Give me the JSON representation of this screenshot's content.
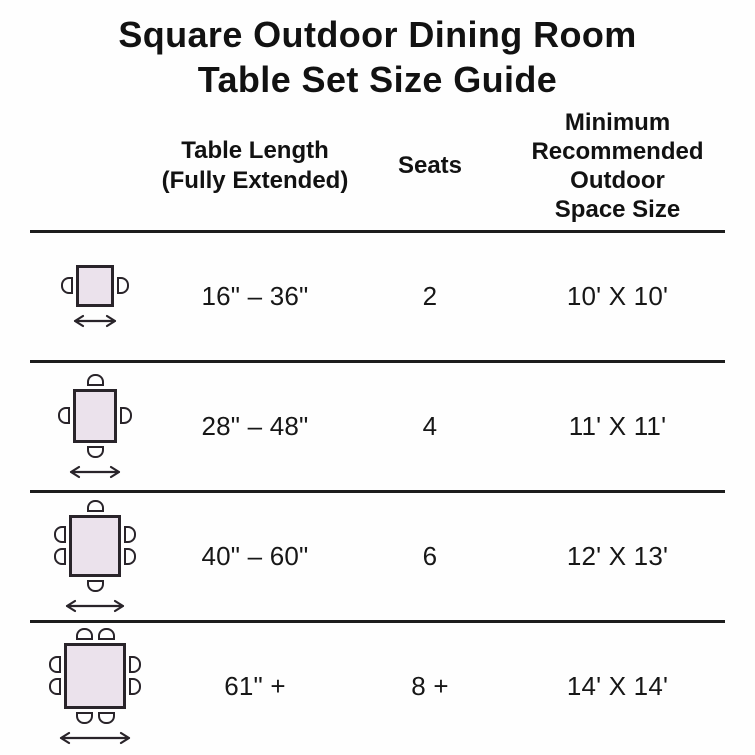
{
  "title": {
    "line1": "Square Outdoor Dining Room",
    "line2": "Table Set Size Guide"
  },
  "columns": {
    "length": {
      "lines": [
        "Table Length",
        "(Fully Extended)"
      ]
    },
    "seats": {
      "label": "Seats"
    },
    "space": {
      "lines": [
        "Minimum",
        "Recommended",
        "Outdoor",
        "Space Size"
      ]
    }
  },
  "rows": [
    {
      "length": "16\" – 36\"",
      "seats": "2",
      "space": "10' X 10'",
      "icon": {
        "name": "square-table-top-view-2-seats",
        "chairs": {
          "top": 0,
          "right": 1,
          "bottom": 0,
          "left": 1
        },
        "table_w": 38,
        "table_h": 42,
        "arrow_w": 46
      }
    },
    {
      "length": "28\" – 48\"",
      "seats": "4",
      "space": "11' X 11'",
      "icon": {
        "name": "square-table-top-view-4-seats",
        "chairs": {
          "top": 1,
          "right": 1,
          "bottom": 1,
          "left": 1
        },
        "table_w": 44,
        "table_h": 54,
        "arrow_w": 54
      }
    },
    {
      "length": "40\" – 60\"",
      "seats": "6",
      "space": "12' X 13'",
      "icon": {
        "name": "square-table-top-view-6-seats",
        "chairs": {
          "top": 1,
          "right": 2,
          "bottom": 1,
          "left": 2
        },
        "table_w": 52,
        "table_h": 62,
        "arrow_w": 62
      }
    },
    {
      "length": "61\" +",
      "seats": "8 +",
      "space": "14' X 14'",
      "icon": {
        "name": "square-table-top-view-8-seats",
        "chairs": {
          "top": 2,
          "right": 2,
          "bottom": 2,
          "left": 2
        },
        "table_w": 62,
        "table_h": 66,
        "arrow_w": 74
      }
    }
  ],
  "colors": {
    "background": "#fefefe",
    "text": "#141414",
    "outline": "#29242a",
    "table_fill": "#ebe2ec",
    "divider": "#1d1d1d"
  },
  "chart_data": {
    "type": "table",
    "title": "Square Outdoor Dining Room Table Set Size Guide",
    "columns": [
      "Table Length (Fully Extended)",
      "Seats",
      "Minimum Recommended Outdoor Space Size"
    ],
    "rows": [
      [
        "16\" – 36\"",
        "2",
        "10' X 10'"
      ],
      [
        "28\" – 48\"",
        "4",
        "11' X 11'"
      ],
      [
        "40\" – 60\"",
        "6",
        "12' X 13'"
      ],
      [
        "61\" +",
        "8 +",
        "14' X 14'"
      ]
    ]
  }
}
